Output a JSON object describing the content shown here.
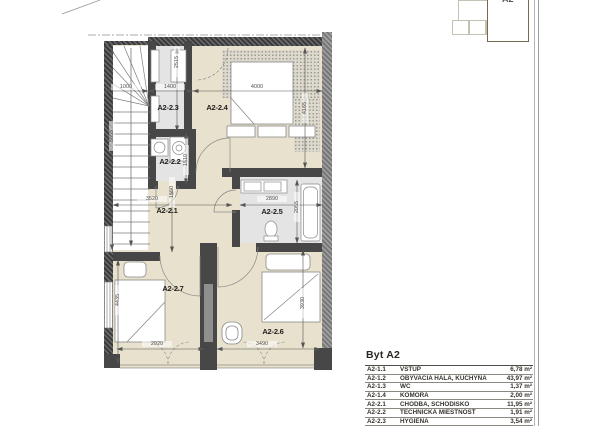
{
  "key_plan": {
    "unit_label": "A2"
  },
  "plan": {
    "rooms": [
      {
        "id": "A2-2.3"
      },
      {
        "id": "A2-2.4"
      },
      {
        "id": "A2-2.2"
      },
      {
        "id": "A2-2.1"
      },
      {
        "id": "A2-2.5"
      },
      {
        "id": "A2-2.7"
      },
      {
        "id": "A2-2.6"
      }
    ],
    "dims": [
      {
        "label": "1000"
      },
      {
        "label": "1400"
      },
      {
        "label": "4000"
      },
      {
        "label": "2515"
      },
      {
        "label": "5855"
      },
      {
        "label": "4165"
      },
      {
        "label": "3520"
      },
      {
        "label": "2890"
      },
      {
        "label": "2055"
      },
      {
        "label": "1510"
      },
      {
        "label": "1550"
      },
      {
        "label": "4435"
      },
      {
        "label": "2920"
      },
      {
        "label": "3490"
      },
      {
        "label": "3930"
      }
    ]
  },
  "legend": {
    "title": "Byt A2",
    "rows": [
      {
        "code": "A2-1.1",
        "name": "VSTUP",
        "area": "6,78 m²"
      },
      {
        "code": "A2-1.2",
        "name": "OBÝVACIA HALA, KUCHYŇA",
        "area": "43,97 m²"
      },
      {
        "code": "A2-1.3",
        "name": "WC",
        "area": "1,37 m²"
      },
      {
        "code": "A2-1.4",
        "name": "KOMORA",
        "area": "2,00 m²"
      },
      {
        "code": "A2-2.1",
        "name": "CHODBA, SCHODISKO",
        "area": "11,95 m²"
      },
      {
        "code": "A2-2.2",
        "name": "TECHNICKÁ MIESTNOSŤ",
        "area": "1,91 m²"
      },
      {
        "code": "A2-2.3",
        "name": "HYGIENA",
        "area": "3,54 m²"
      }
    ]
  }
}
